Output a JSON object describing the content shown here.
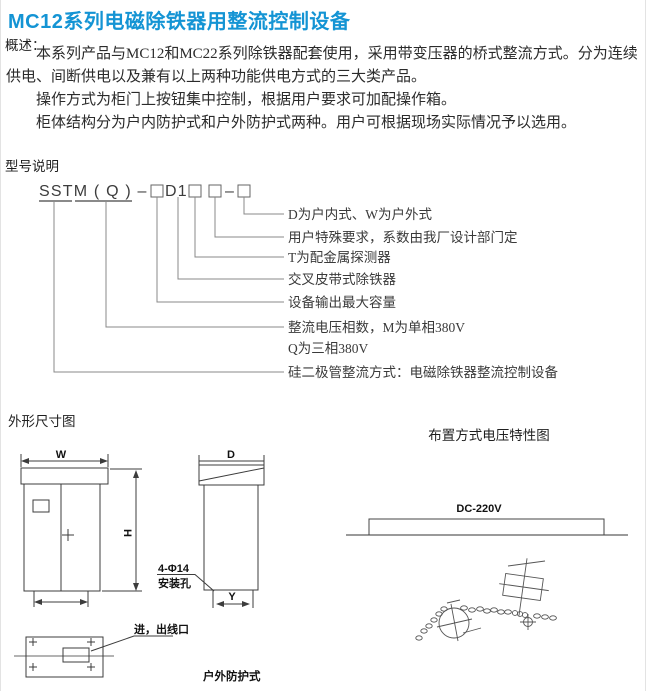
{
  "page": {
    "title": "MC12系列电磁除铁器用整流控制设备",
    "accent_color": "#1494d4"
  },
  "overview": {
    "heading": "概述：",
    "paragraphs": [
      "本系列产品与MC12和MC22系列除铁器配套使用，采用带变压器的桥式整流方式。分为连续供电、间断供电以及兼有以上两种功能供电方式的三大类产品。",
      "操作方式为柜门上按钮集中控制，根据用户要求可加配操作箱。",
      "柜体结构分为户内防护式和户外防护式两种。用户可根据现场实际情况予以选用。"
    ]
  },
  "model": {
    "heading": "型号说明",
    "code_prefix": "SSTM ( Q ) –",
    "code_mid": "D1",
    "code_dash": "–",
    "labels": [
      "D为户内式、W为户外式",
      "用户特殊要求，系数由我厂设计部门定",
      "T为配金属探测器",
      "交叉皮带式除铁器",
      "设备输出最大容量",
      "整流电压相数，M为单相380V",
      "Q为三相380V",
      "硅二极管整流方式：电磁除铁器整流控制设备"
    ]
  },
  "dimension_figure": {
    "heading": "外形尺寸图",
    "dim_w": "W",
    "dim_h": "H",
    "dim_d": "D",
    "dim_y": "Y",
    "mount_hole_line1": "4-Φ14",
    "mount_hole_line2": "安装孔",
    "port_label": "进，出线口",
    "type_label": "户外防护式"
  },
  "voltage_figure": {
    "heading": "布置方式电压特性图",
    "voltage_label": "DC-220V"
  }
}
